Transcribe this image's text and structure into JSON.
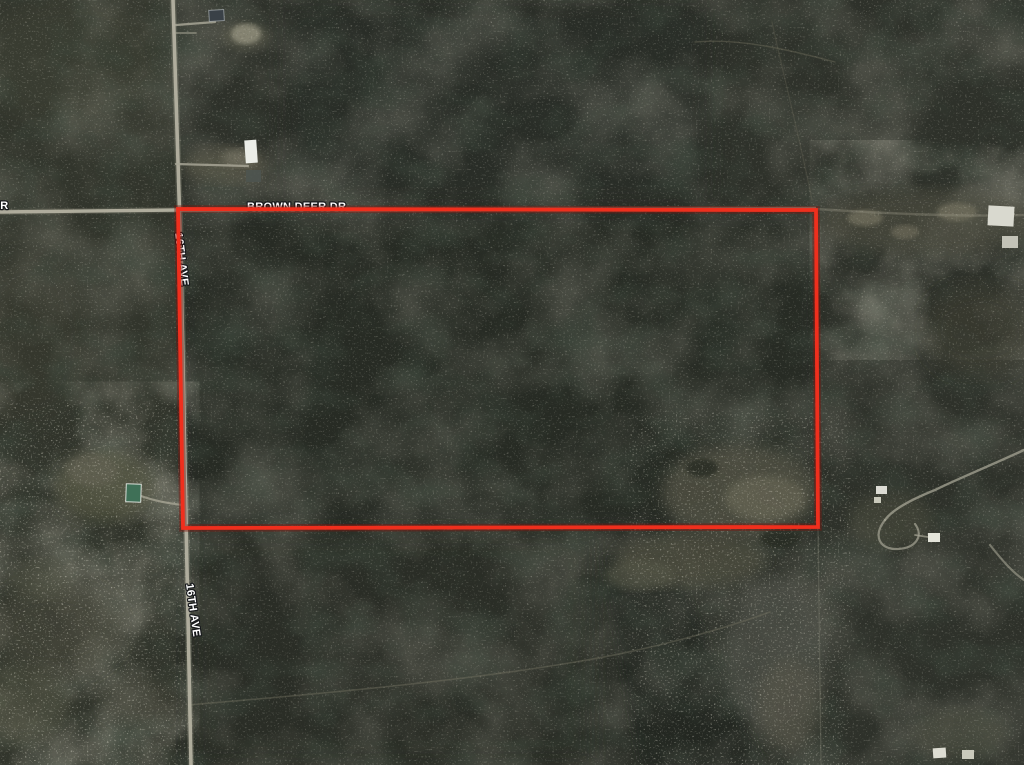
{
  "map": {
    "view": "satellite-aerial",
    "roads": {
      "brown_deer_label": "BROWN DEER DR",
      "left_edge_fragment": "DR",
      "sixteenth_ave_upper": "16TH AVE",
      "sixteenth_ave_lower": "16TH AVE"
    },
    "boundary": {
      "color": "#ef2f1d",
      "glow_color": "#7a130a",
      "points": "178,209 816,210 818,527 183,528"
    },
    "colors": {
      "forest_base": "#2e312a",
      "forest_dark": "#1c211b",
      "left_strip": "#3e4034",
      "clearing": "#535446",
      "clearing_bright": "#6c6a58",
      "road": "#b4b1a1",
      "driveway": "#a7a595",
      "label_fill": "#ffffff",
      "label_halo": "#17191c"
    }
  }
}
